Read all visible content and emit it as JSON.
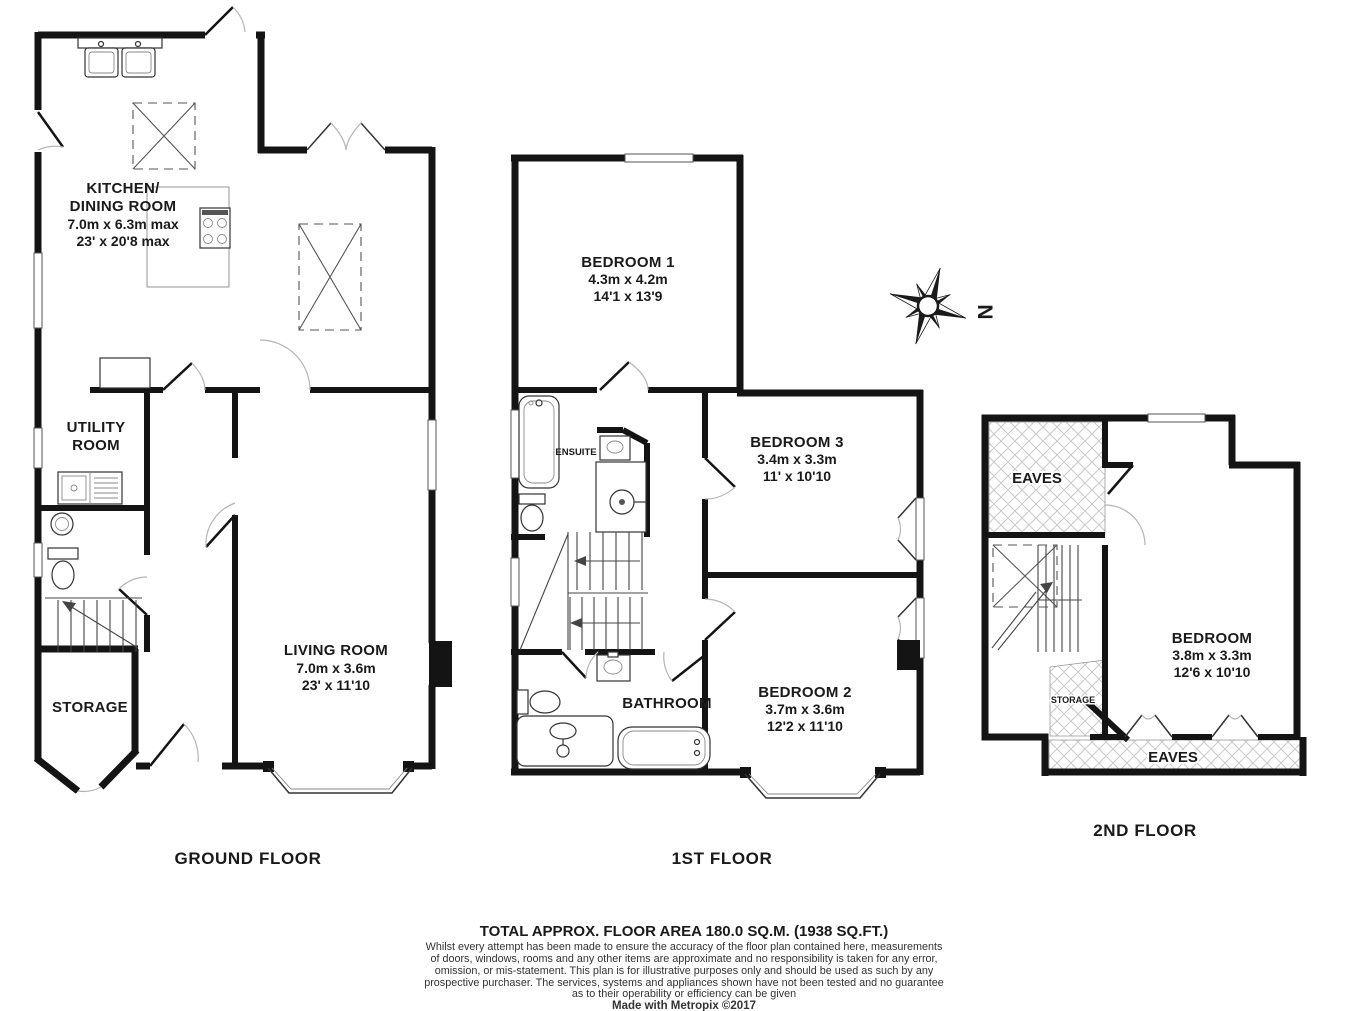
{
  "floors": {
    "ground": {
      "label": "GROUND FLOOR",
      "kitchen": {
        "name1": "KITCHEN/",
        "name2": "DINING ROOM",
        "dim_m": "7.0m x 6.3m max",
        "dim_ft": "23' x 20'8 max"
      },
      "utility": {
        "name1": "UTILITY",
        "name2": "ROOM"
      },
      "living": {
        "name": "LIVING ROOM",
        "dim_m": "7.0m x 3.6m",
        "dim_ft": "23' x 11'10"
      },
      "storage": {
        "name": "STORAGE"
      }
    },
    "first": {
      "label": "1ST FLOOR",
      "bedroom1": {
        "name": "BEDROOM 1",
        "dim_m": "4.3m x 4.2m",
        "dim_ft": "14'1 x 13'9"
      },
      "bedroom3": {
        "name": "BEDROOM 3",
        "dim_m": "3.4m x 3.3m",
        "dim_ft": "11' x 10'10"
      },
      "bedroom2": {
        "name": "BEDROOM 2",
        "dim_m": "3.7m x 3.6m",
        "dim_ft": "12'2 x 11'10"
      },
      "ensuite": {
        "name": "ENSUITE"
      },
      "bathroom": {
        "name": "BATHROOM"
      }
    },
    "second": {
      "label": "2ND FLOOR",
      "bedroom": {
        "name": "BEDROOM",
        "dim_m": "3.8m x 3.3m",
        "dim_ft": "12'6 x 10'10"
      },
      "eaves_top": {
        "name": "EAVES"
      },
      "eaves_bottom": {
        "name": "EAVES"
      },
      "storage": {
        "name": "STORAGE"
      }
    }
  },
  "compass": {
    "north": "N"
  },
  "footer": {
    "total_area": "TOTAL APPROX. FLOOR AREA 180.0 SQ.M. (1938 SQ.FT.)",
    "disclaimer_line1": "Whilst every attempt has been made to ensure the accuracy of the floor plan contained here, measurements",
    "disclaimer_line2": "of doors, windows, rooms and any other items are approximate and no responsibility is taken for any error,",
    "disclaimer_line3": "omission, or mis-statement. This plan is for illustrative purposes only and should be used as such by any",
    "disclaimer_line4": "prospective purchaser. The services, systems and appliances shown have not been tested and no guarantee",
    "disclaimer_line5": "as to their operability or efficiency can be given",
    "credit": "Made with Metropix ©2017"
  }
}
